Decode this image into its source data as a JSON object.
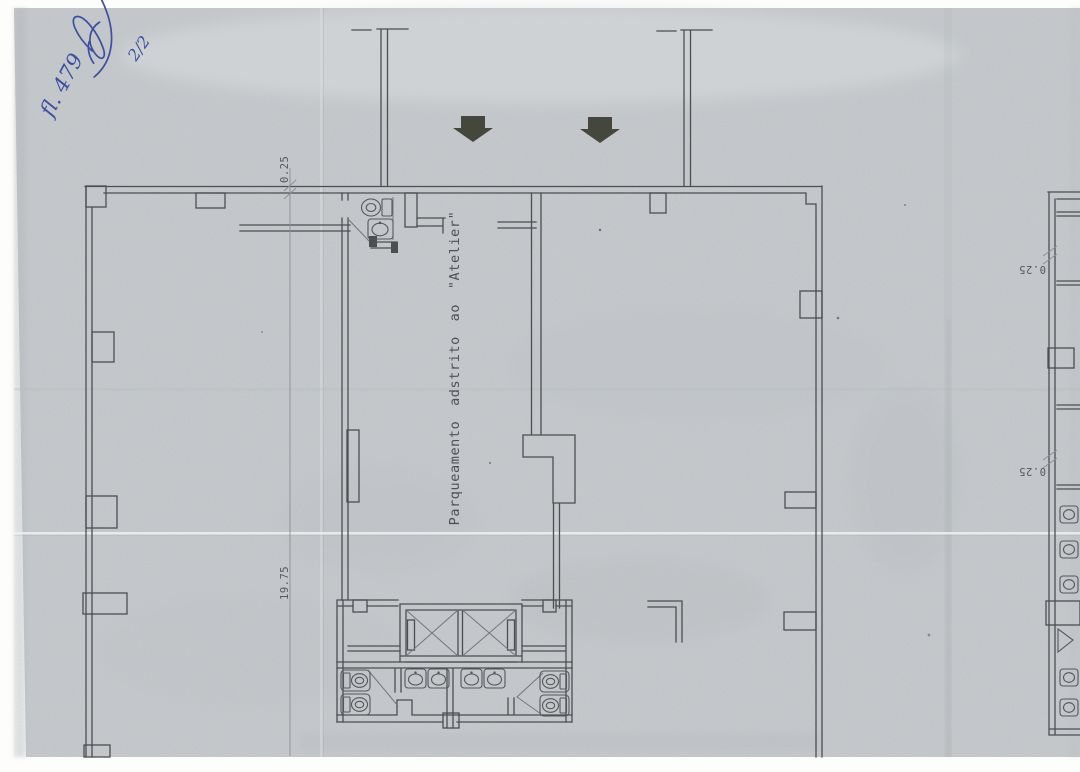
{
  "document": {
    "kind": "Scanned architectural floor plan (garage / parking level)",
    "language": "Portuguese"
  },
  "annotations": {
    "folio": "fl. 479",
    "page_fraction": "2/2",
    "signature": "handwritten paraph in blue ink"
  },
  "labels": {
    "parking_zone": "Parqueamento adstrito ao \"Atelier\"",
    "dim_top_wall": "0.25",
    "dim_length": "19.75",
    "dim_right_upper": "0.25",
    "dim_right_lower": "0.25"
  },
  "icons": {
    "down_arrow": "solid ramp direction arrow pointing down",
    "toilet": "WC pan symbol",
    "sink": "wash basin symbol",
    "elevator_x": "lift shaft crossed diagonals",
    "door_swing": "diagonal door leaf line"
  },
  "colors": {
    "paper": "#c6cacd",
    "paper_light": "#d6d9db",
    "paper_shadow": "#a9adb1",
    "scan_white": "#fdfdfb",
    "plan_line": "#4c4e52",
    "arrow": "#46473c",
    "ink_blue": "#3c4fa2"
  }
}
